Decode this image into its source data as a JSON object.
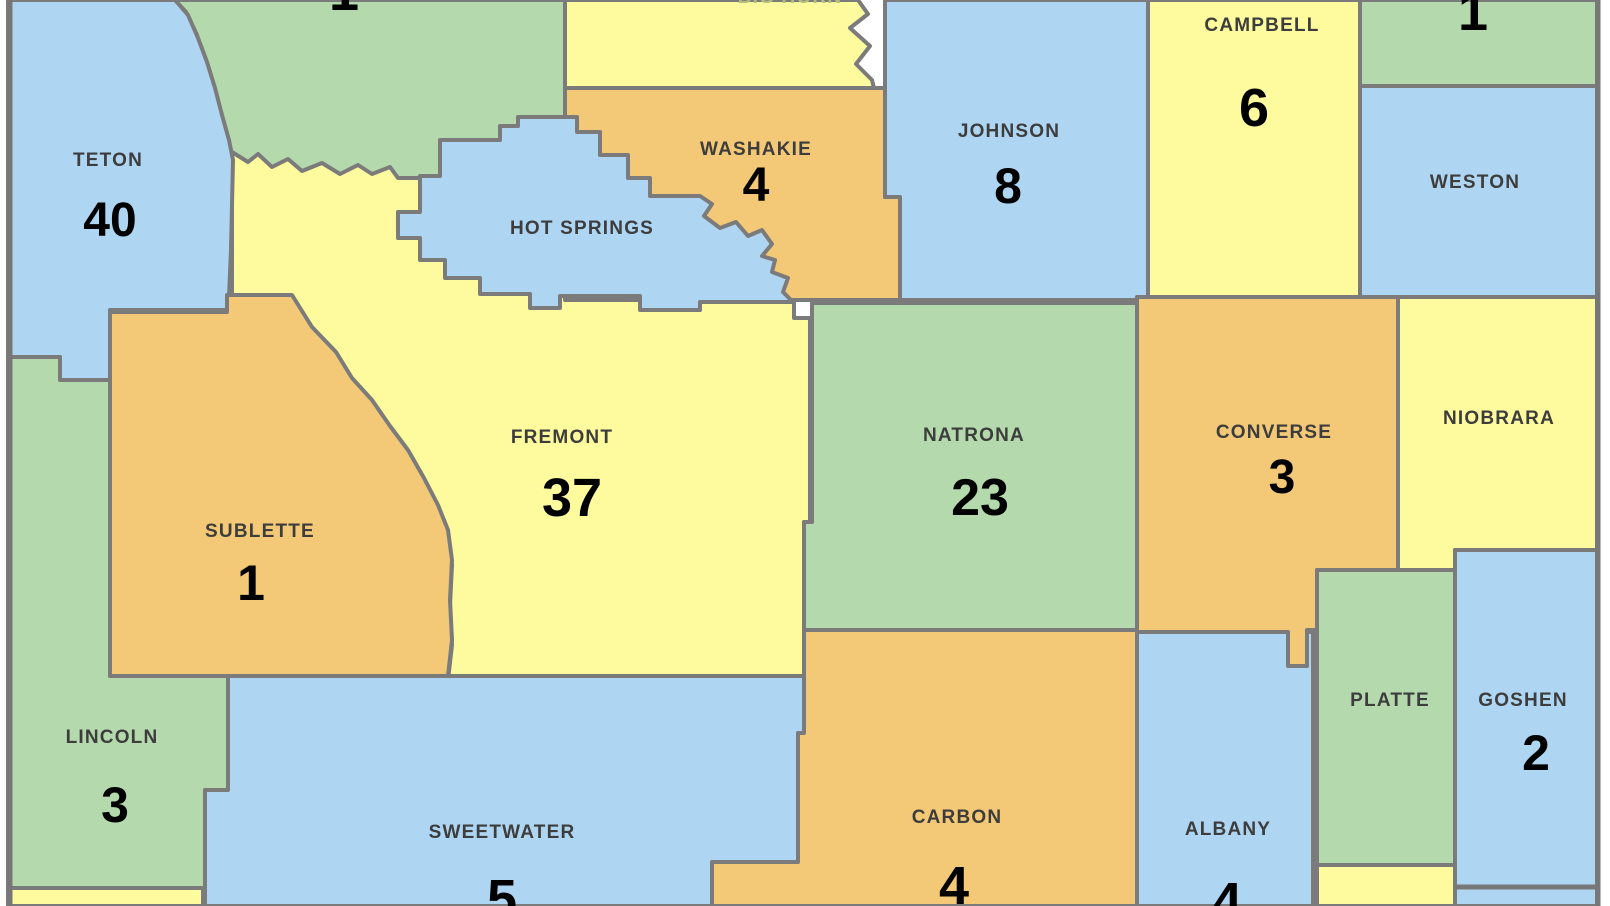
{
  "map": {
    "description": "Wyoming county map with per-county counts (viewport cropped on all sides)",
    "colors": {
      "blue": "#aed5f2",
      "green": "#b4d9ac",
      "yellow": "#fdfb9e",
      "orange": "#f3c876",
      "border": "#7b7b7b",
      "state_border": "#777777",
      "name_text": "#3d3d3d",
      "number_text": "#000000"
    },
    "counties": [
      {
        "id": "park",
        "name": "",
        "number": "1",
        "color": "green",
        "number_xy": [
          344,
          10
        ],
        "number_size": 54,
        "points": "175,0 565,0 565,128 500,128 500,235 228,235 222,150 215,115 207,70 197,35 186,12"
      },
      {
        "id": "bighorn",
        "name": "BIG HORN",
        "number": "",
        "color": "yellow",
        "name_xy": [
          790,
          3
        ],
        "name_color": "#b5bd7e",
        "points": "565,0 858,0 868,14 850,28 870,46 856,64 872,80 874,88 565,88"
      },
      {
        "id": "fremont",
        "name": "FREMONT",
        "number": "37",
        "color": "yellow",
        "name_xy": [
          562,
          443
        ],
        "number_xy": [
          572,
          516
        ],
        "number_size": 54,
        "points": "232,152 248,162 258,154 272,167 288,159 302,171 322,163 340,174 358,165 372,174 390,167 398,178 793,178 794,303 794,318 810,318 810,522 804,522 804,680 448,680 452,645 450,605 452,565 446,532 436,505 422,478 406,450 388,427 370,401 350,379 334,353 312,327 290,296 232,296"
      },
      {
        "id": "teton",
        "name": "TETON",
        "number": "40",
        "color": "blue",
        "name_xy": [
          108,
          166
        ],
        "number_xy": [
          110,
          236
        ],
        "number_size": 48,
        "points": "8,0 175,0 188,15 198,38 207,62 215,88 222,115 229,140 233,160 231,250 229,296 227,296 227,310 110,310 110,380 60,380 60,357 8,357"
      },
      {
        "id": "washakie",
        "name": "WASHAKIE",
        "number": "4",
        "color": "orange",
        "name_xy": [
          756,
          155
        ],
        "number_xy": [
          756,
          201
        ],
        "number_size": 48,
        "points": "565,88 885,88 885,197 900,197 900,300 565,300"
      },
      {
        "id": "hotsprings",
        "name": "HOT SPRINGS",
        "number": "",
        "color": "blue",
        "name_xy": [
          582,
          234
        ],
        "points": "518,117 577,117 577,132 600,132 600,155 628,155 628,178 650,178 650,196 700,196 712,204 704,216 720,228 736,222 748,236 762,230 772,244 762,256 775,260 772,272 788,278 783,292 793,302 700,302 700,310 640,310 640,296 560,296 560,308 530,308 530,294 480,294 480,278 445,278 445,260 420,260 420,238 398,238 398,212 420,212 420,176 440,176 440,140 500,140 500,126 518,126"
      },
      {
        "id": "johnson",
        "name": "JOHNSON",
        "number": "8",
        "color": "blue",
        "name_xy": [
          1009,
          137
        ],
        "number_xy": [
          1008,
          203
        ],
        "number_size": 50,
        "points": "885,0 1148,0 1148,300 900,300 900,197 885,197"
      },
      {
        "id": "campbell",
        "name": "CAMPBELL",
        "number": "6",
        "color": "yellow",
        "name_xy": [
          1262,
          31
        ],
        "number_xy": [
          1254,
          126
        ],
        "number_size": 54,
        "points": "1148,0 1360,0 1360,297 1148,297"
      },
      {
        "id": "crook",
        "name": "",
        "number": "1",
        "color": "green",
        "number_xy": [
          1473,
          30
        ],
        "number_size": 54,
        "points": "1360,0 1597,0 1597,86 1360,86"
      },
      {
        "id": "weston",
        "name": "WESTON",
        "number": "",
        "color": "blue",
        "name_xy": [
          1475,
          188
        ],
        "points": "1360,86 1597,86 1597,297 1360,297"
      },
      {
        "id": "natrona",
        "name": "NATRONA",
        "number": "23",
        "color": "green",
        "name_xy": [
          974,
          441
        ],
        "number_xy": [
          980,
          515
        ],
        "number_size": 52,
        "points": "812,303 1137,303 1137,630 804,630 804,522 812,522"
      },
      {
        "id": "sublette",
        "name": "SUBLETTE",
        "number": "1",
        "color": "orange",
        "name_xy": [
          260,
          537
        ],
        "number_xy": [
          251,
          600
        ],
        "number_size": 50,
        "points": "227,295 292,295 312,327 336,352 352,378 372,400 390,426 408,450 424,478 438,505 448,530 452,560 450,600 452,640 448,676 110,676 110,532 102,532 102,520 110,520 110,312 227,312"
      },
      {
        "id": "lincoln",
        "name": "LINCOLN",
        "number": "3",
        "color": "green",
        "name_xy": [
          112,
          743
        ],
        "number_xy": [
          115,
          822
        ],
        "number_size": 50,
        "points": "8,357 60,357 60,380 110,380 110,676 228,676 228,790 205,790 205,900 8,900"
      },
      {
        "id": "uinta",
        "name": "",
        "number": "",
        "color": "yellow",
        "points": "8,888 203,888 203,906 8,906"
      },
      {
        "id": "sweetwater",
        "name": "SWEETWATER",
        "number": "5",
        "color": "blue",
        "name_xy": [
          502,
          838
        ],
        "number_xy": [
          502,
          917
        ],
        "number_size": 54,
        "points": "228,676 804,676 804,906 205,906 205,790 228,790"
      },
      {
        "id": "carbon",
        "name": "CARBON",
        "number": "4",
        "color": "orange",
        "name_xy": [
          957,
          823
        ],
        "number_xy": [
          954,
          904
        ],
        "number_size": 54,
        "points": "804,630 1137,630 1137,906 712,906 712,862 798,862 798,733 804,733"
      },
      {
        "id": "albany",
        "name": "ALBANY",
        "number": "4",
        "color": "blue",
        "name_xy": [
          1228,
          835
        ],
        "number_xy": [
          1227,
          920
        ],
        "number_size": 54,
        "points": "1137,632 1313,632 1313,906 1137,906"
      },
      {
        "id": "converse",
        "name": "CONVERSE",
        "number": "3",
        "color": "orange",
        "name_xy": [
          1274,
          438
        ],
        "number_xy": [
          1282,
          493
        ],
        "number_size": 48,
        "points": "1137,297 1398,297 1398,570 1317,570 1317,630 1307,630 1307,666 1288,666 1288,632 1137,632"
      },
      {
        "id": "niobrara",
        "name": "NIOBRARA",
        "number": "",
        "color": "yellow",
        "name_xy": [
          1499,
          424
        ],
        "points": "1398,297 1597,297 1597,550 1455,550 1455,570 1398,570"
      },
      {
        "id": "platte",
        "name": "PLATTE",
        "number": "",
        "color": "green",
        "name_xy": [
          1390,
          706
        ],
        "points": "1317,570 1455,570 1455,865 1317,865"
      },
      {
        "id": "goshen",
        "name": "GOSHEN",
        "number": "2",
        "color": "blue",
        "name_xy": [
          1523,
          706
        ],
        "number_xy": [
          1536,
          770
        ],
        "number_size": 50,
        "points": "1455,550 1597,550 1597,906 1455,906"
      },
      {
        "id": "laramie",
        "name": "",
        "number": "",
        "color": "yellow",
        "points": "1317,865 1455,865 1455,906 1317,906"
      }
    ]
  }
}
